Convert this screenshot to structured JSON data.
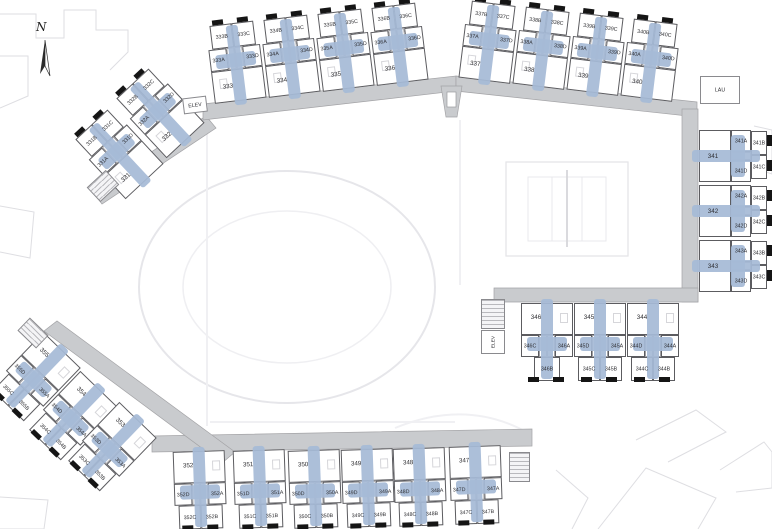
{
  "compass_label": "N",
  "utilities": {
    "elevator": "ELEV",
    "laundry": "LAU"
  },
  "wings": [
    {
      "name": "northwest wing",
      "buildings": [
        {
          "id": "331",
          "main": "331",
          "a": "331A",
          "b": "331B",
          "c": "331C",
          "d": "331D"
        },
        {
          "id": "332",
          "main": "332",
          "a": "332A",
          "b": "332B",
          "c": "332C",
          "d": "332D"
        }
      ]
    },
    {
      "name": "north wing",
      "buildings": [
        {
          "id": "333",
          "main": "333",
          "a": "333A",
          "b": "333B",
          "c": "333C",
          "d": "333D"
        },
        {
          "id": "334",
          "main": "334",
          "a": "334A",
          "b": "334B",
          "c": "334C",
          "d": "334D"
        },
        {
          "id": "335",
          "main": "335",
          "a": "335A",
          "b": "335B",
          "c": "335C",
          "d": "335D"
        },
        {
          "id": "336",
          "main": "336",
          "a": "336A",
          "b": "336B",
          "c": "336C",
          "d": "336D"
        }
      ]
    },
    {
      "name": "northeast wing",
      "buildings": [
        {
          "id": "337",
          "main": "337",
          "a": "337A",
          "b": "337B",
          "c": "337C",
          "d": "337D"
        },
        {
          "id": "338",
          "main": "338",
          "a": "338A",
          "b": "338B",
          "c": "338C",
          "d": "338D"
        },
        {
          "id": "339",
          "main": "339",
          "a": "339A",
          "b": "339B",
          "c": "339C",
          "d": "339D"
        },
        {
          "id": "340",
          "main": "340",
          "a": "340A",
          "b": "340B",
          "c": "340C",
          "d": "340D"
        }
      ]
    },
    {
      "name": "east wing",
      "buildings": [
        {
          "id": "341",
          "main": "341",
          "a": "341A",
          "b": "341B",
          "c": "341C",
          "d": "341D"
        },
        {
          "id": "342",
          "main": "342",
          "a": "342A",
          "b": "342B",
          "c": "342C",
          "d": "342D"
        },
        {
          "id": "343",
          "main": "343",
          "a": "343A",
          "b": "343B",
          "c": "343C",
          "d": "343D"
        }
      ]
    },
    {
      "name": "central east wing",
      "buildings": [
        {
          "id": "346",
          "main": "346",
          "a": "346A",
          "b": "346B",
          "c": "346C"
        },
        {
          "id": "345",
          "main": "345",
          "a": "345A",
          "b": "345B",
          "c": "345C",
          "d": "345D"
        },
        {
          "id": "344",
          "main": "344",
          "a": "344A",
          "b": "344B",
          "c": "344C",
          "d": "344D"
        }
      ]
    },
    {
      "name": "south wing",
      "buildings": [
        {
          "id": "352",
          "main": "352",
          "a": "352A",
          "b": "352B",
          "c": "352C",
          "d": "352D"
        },
        {
          "id": "351",
          "main": "351",
          "a": "351A",
          "b": "351B",
          "c": "351C",
          "d": "351D"
        },
        {
          "id": "350",
          "main": "350",
          "a": "350A",
          "b": "350B",
          "c": "350C",
          "d": "350D"
        },
        {
          "id": "349",
          "main": "349",
          "a": "349A",
          "b": "349B",
          "c": "349C",
          "d": "349D"
        },
        {
          "id": "348",
          "main": "348",
          "a": "348A",
          "b": "348B",
          "c": "348C",
          "d": "348D"
        },
        {
          "id": "347",
          "main": "347",
          "a": "347A",
          "b": "347B",
          "c": "347C",
          "d": "347D"
        }
      ]
    },
    {
      "name": "southwest wing",
      "buildings": [
        {
          "id": "355",
          "main": "355",
          "a": "355A",
          "b": "355B",
          "c": "355C",
          "d": "355D"
        },
        {
          "id": "354",
          "main": "354",
          "a": "354A",
          "b": "354B",
          "c": "354C",
          "d": "354D"
        },
        {
          "id": "353",
          "main": "353",
          "a": "353A",
          "b": "353B",
          "c": "353C",
          "d": "353D"
        }
      ]
    }
  ]
}
